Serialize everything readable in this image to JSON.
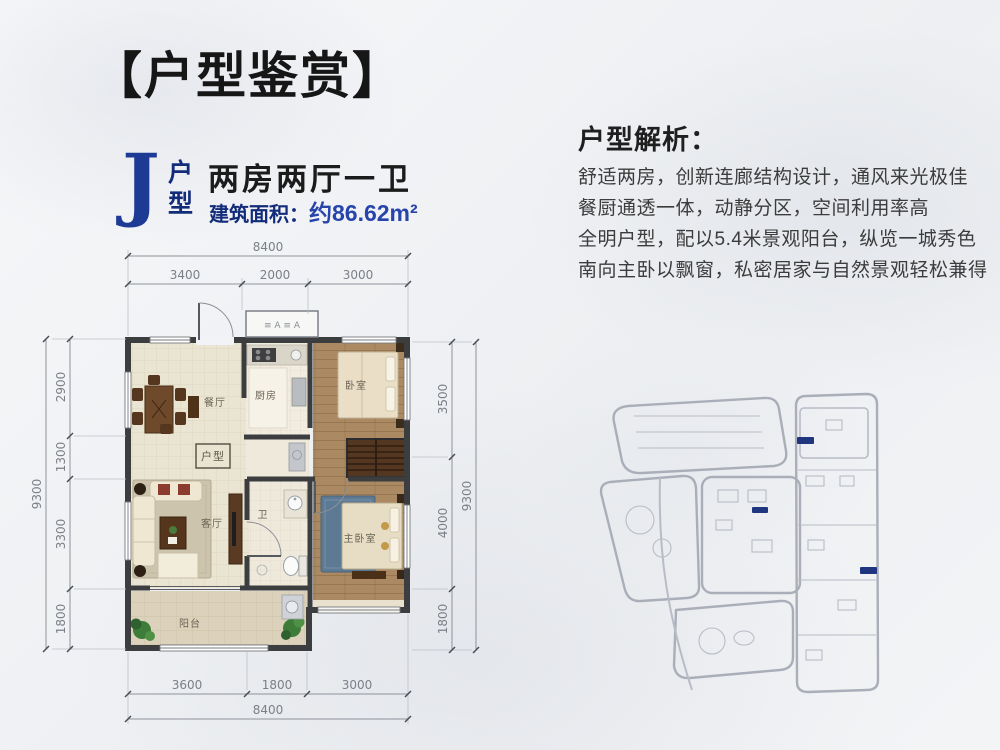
{
  "header": {
    "title": "【户型鉴赏】"
  },
  "unit": {
    "type_letter": "J",
    "type_label_top": "户",
    "type_label_bottom": "型",
    "layout": "两房两厅一卫",
    "area_label": "建筑面积：",
    "area_value": "约86.62m²"
  },
  "analysis": {
    "heading": "户型解析：",
    "lines": [
      "舒适两房，创新连廊结构设计，通风来光极佳",
      "餐厨通透一体，动静分区，空间利用率高",
      "全明户型，配以5.4米景观阳台，纵览一城秀色",
      "南向主卧以飘窗，私密居家与自然景观轻松兼得"
    ]
  },
  "plan": {
    "rooms": {
      "dining": "餐厅",
      "kitchen": "厨房",
      "bedroom": "卧室",
      "living": "客厅",
      "bath": "卫",
      "master": "主卧室",
      "balcony": "阳台"
    },
    "floor_tag": "户型",
    "ac_marks": "≡ A ≡ A",
    "dims": {
      "top_total": "8400",
      "top": [
        "3400",
        "2000",
        "3000"
      ],
      "bottom_total": "8400",
      "bottom": [
        "3600",
        "1800",
        "3000"
      ],
      "left_total": "9300",
      "left": [
        "2900",
        "1300",
        "3300",
        "1800"
      ],
      "right_total": "9300",
      "right": [
        "3500",
        "4000",
        "1800"
      ]
    }
  },
  "colors": {
    "accent_blue": "#1d3a94",
    "navy": "#132c7a",
    "highlight_building": "#20357f"
  }
}
